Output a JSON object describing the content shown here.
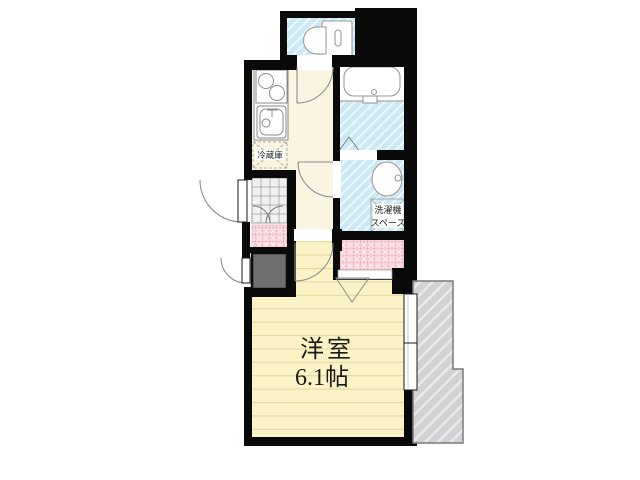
{
  "floor_plan": {
    "western_room": {
      "name": "洋室",
      "size": "6.1帖"
    },
    "kitchen": {
      "refrigerator": "冷蔵庫"
    },
    "laundry": {
      "line1": "洗濯機",
      "line2": "スペース"
    },
    "colors": {
      "wall": "#0a0a0a",
      "wet_area_cyan": "#cbe9f6",
      "hall_cream": "#f9f5e1",
      "room_flooring": "#fbf3c5",
      "closet_pink": "#f7cad3",
      "balcony_gray": "#d2d2d4",
      "storage_gray": "#6f6f6f"
    }
  }
}
